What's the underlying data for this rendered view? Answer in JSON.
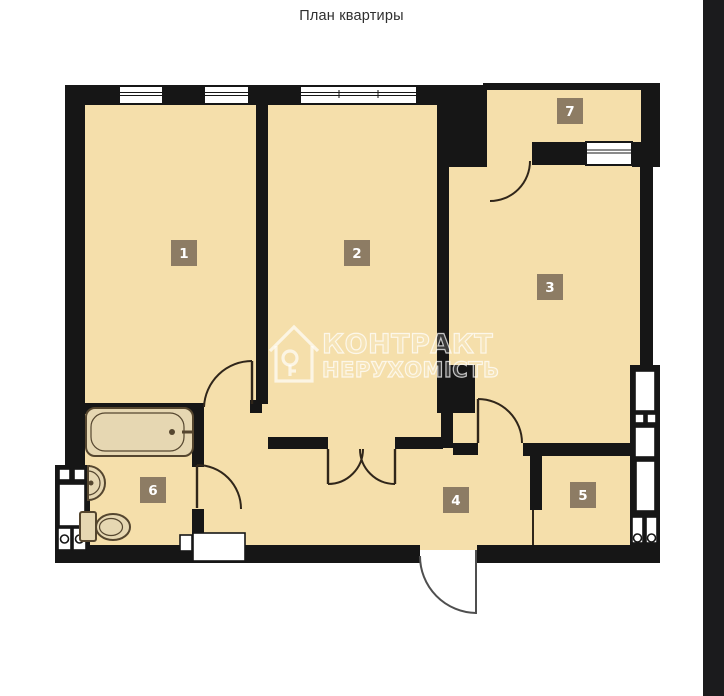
{
  "title": "План квартиры",
  "watermark": {
    "brand_line1": "КОНТРАКТ",
    "brand_line2": "НЕРУХОМІСТЬ"
  },
  "rooms": [
    {
      "number": "1"
    },
    {
      "number": "2"
    },
    {
      "number": "3"
    },
    {
      "number": "4"
    },
    {
      "number": "5"
    },
    {
      "number": "6"
    },
    {
      "number": "7"
    }
  ],
  "colors": {
    "floor": "#f5dfab",
    "wall": "#161616",
    "label_bg": "#8d7c64",
    "label_text": "#ffffff",
    "door_line": "#30261a",
    "fixture_fill": "#e6d7b2",
    "fixture_stroke": "#55462f",
    "side_strip": "#1b1b1d",
    "title_text": "#2f2f2f",
    "watermark_white": "#ffffff"
  }
}
